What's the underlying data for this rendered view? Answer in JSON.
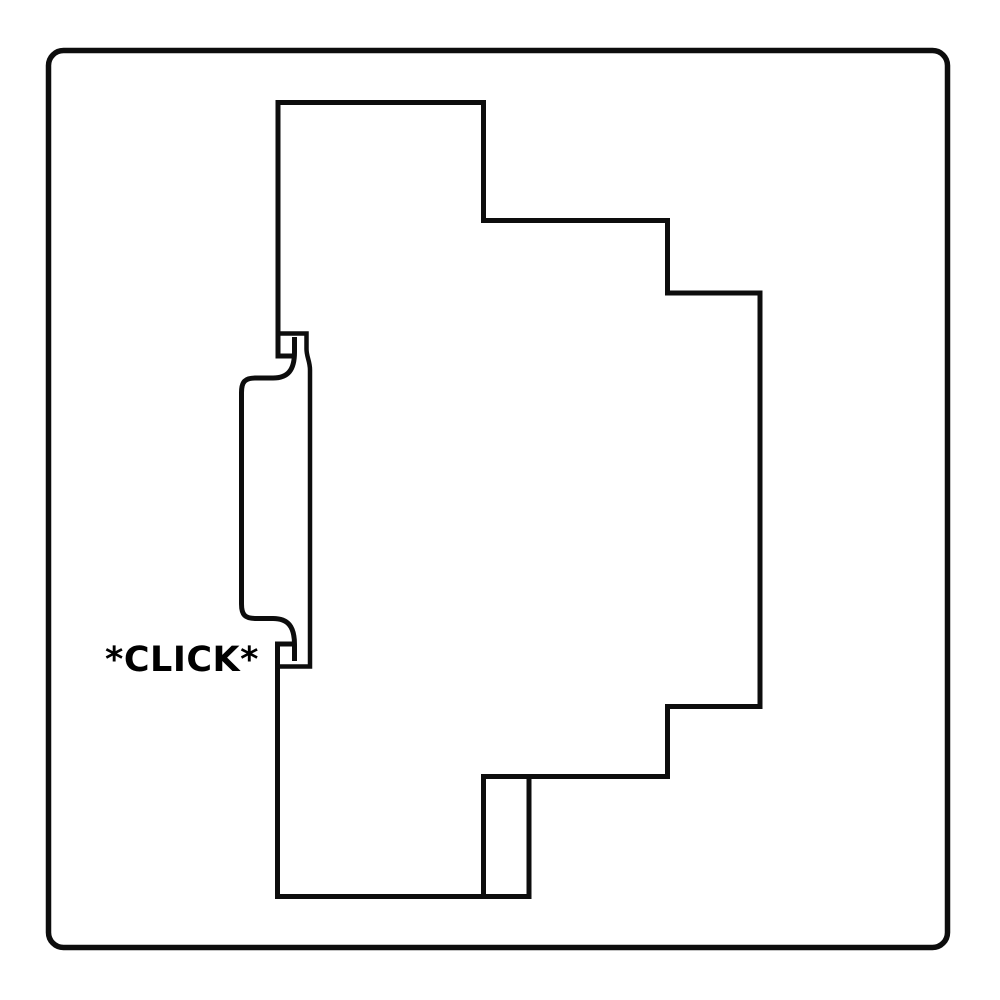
{
  "label": {
    "click": "*CLICK*"
  },
  "colors": {
    "line": "#0d0d0d",
    "background": "#ffffff",
    "text": "#000000"
  },
  "scene": {
    "frame": "rounded-square-border",
    "module": "din-rail-module-side-profile",
    "rail": "din-rail-cross-section"
  }
}
